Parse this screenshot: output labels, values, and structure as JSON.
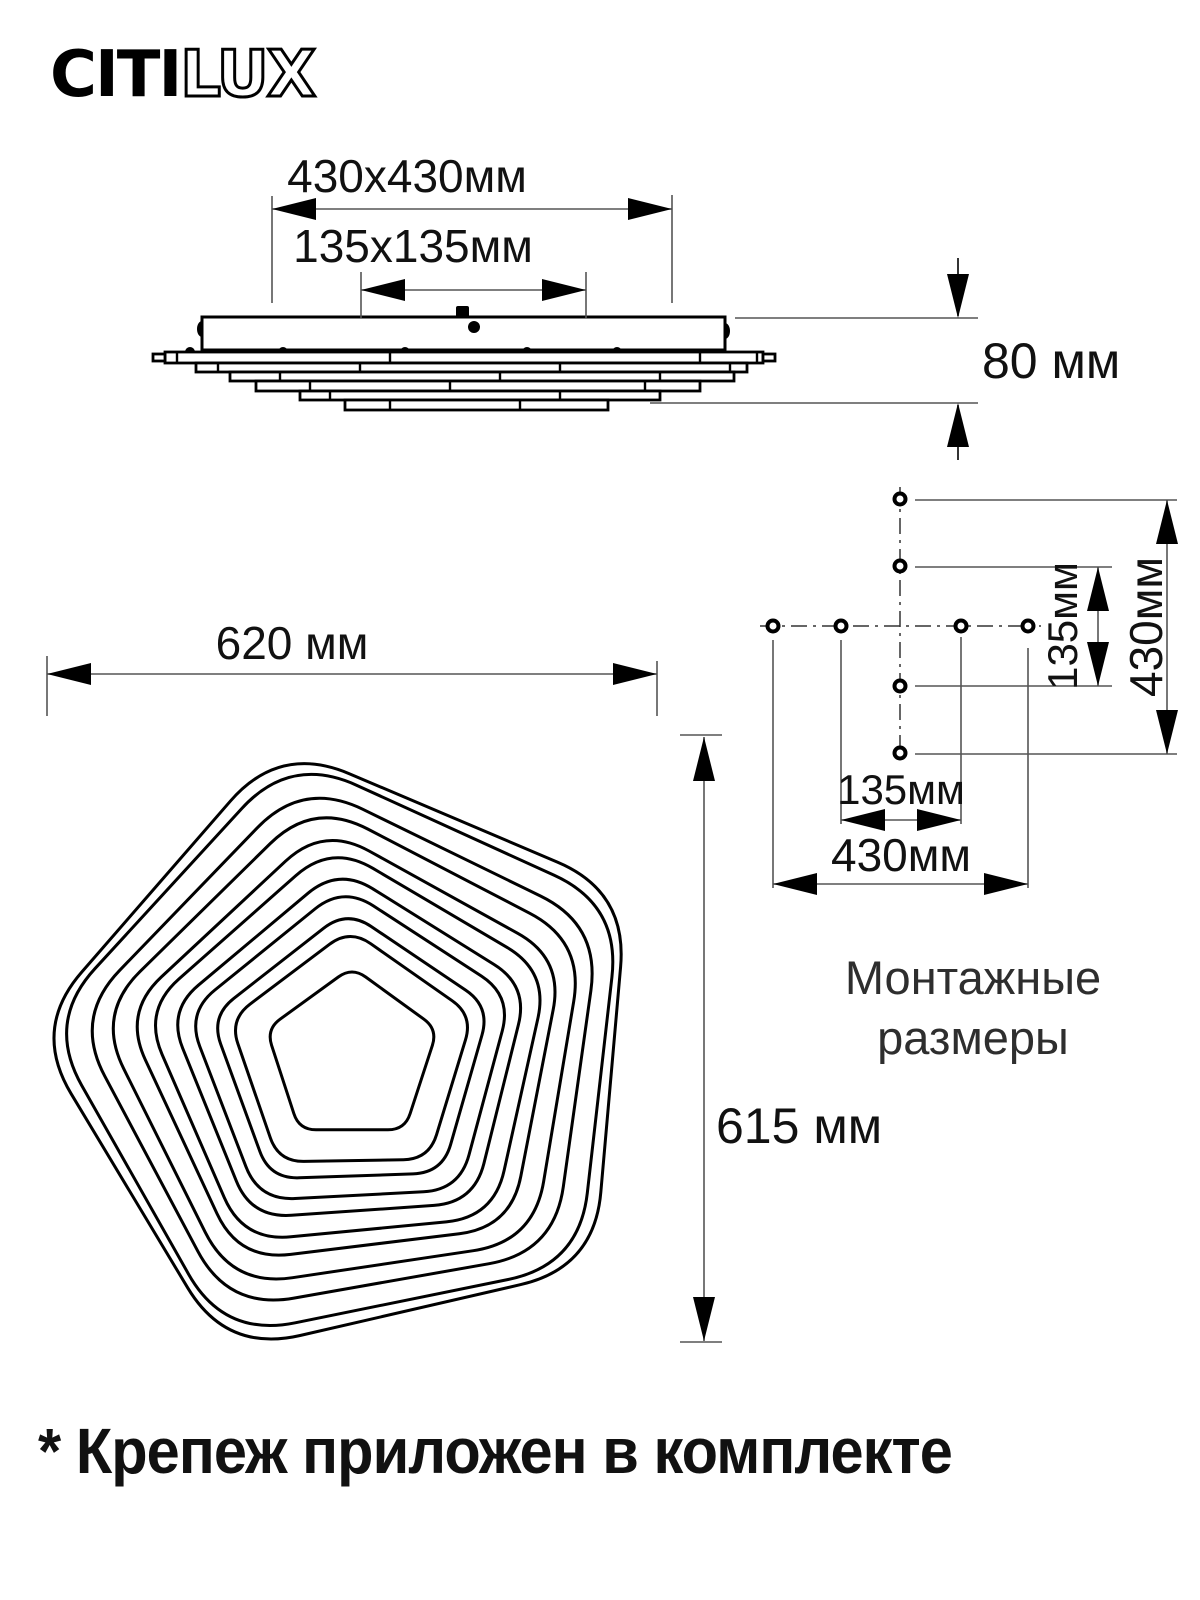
{
  "logo": {
    "text_solid": "CITI",
    "text_outline": "LUX"
  },
  "side_view": {
    "width_dim": "430x430мм",
    "inner_dim": "135x135мм",
    "height_dim": "80 мм"
  },
  "plan_view": {
    "width_dim": "620 мм",
    "height_dim": "615 мм"
  },
  "mounting": {
    "vertical_inner_dim": "135мм",
    "vertical_outer_dim": "430мм",
    "horizontal_inner_dim": "135мм",
    "horizontal_outer_dim": "430мм",
    "caption_line1": "Монтажные",
    "caption_line2": "размеры"
  },
  "footnote": "* Крепеж приложен в комплекте",
  "colors": {
    "line": "#000000",
    "thin_line": "#555555",
    "text": "#111111"
  }
}
